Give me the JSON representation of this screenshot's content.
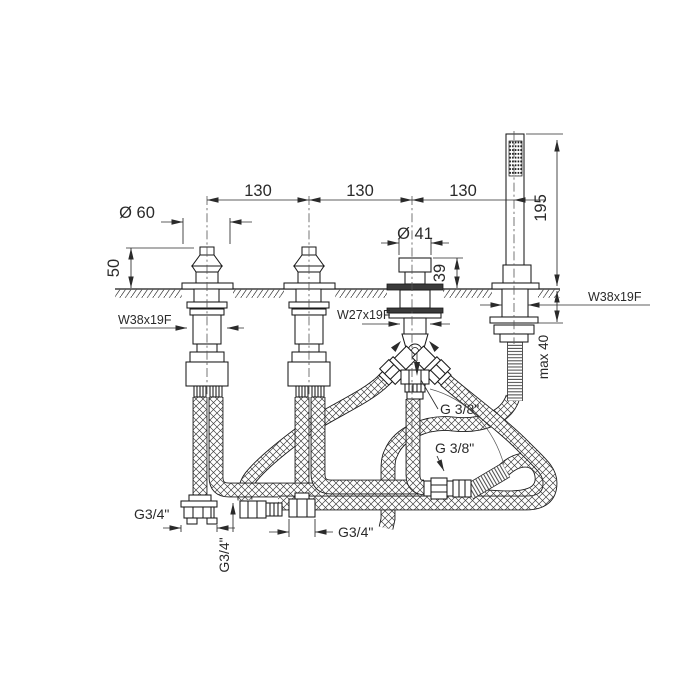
{
  "colors": {
    "line": "#1a1a1a",
    "text": "#2a2a2a",
    "background": "#ffffff"
  },
  "drawing": {
    "type": "bath-mixer-installation-diagram",
    "labels": {
      "dim_130_a": "130",
      "dim_130_b": "130",
      "dim_130_c": "130",
      "dia_60": "Ø 60",
      "height_50": "50",
      "dia_41": "Ø 41",
      "height_39": "39",
      "height_195": "195",
      "max_40": "max 40",
      "thread_valve": "W38x19F",
      "thread_spout": "W27x19F",
      "thread_shower": "W38x19F",
      "conn_g38_top": "G 3/8\"",
      "conn_g38_bottom": "G 3/8\"",
      "conn_g34_left": "G3/4\"",
      "conn_g34_vertical": "G3/4\"",
      "conn_g34_middle": "G3/4\""
    }
  }
}
